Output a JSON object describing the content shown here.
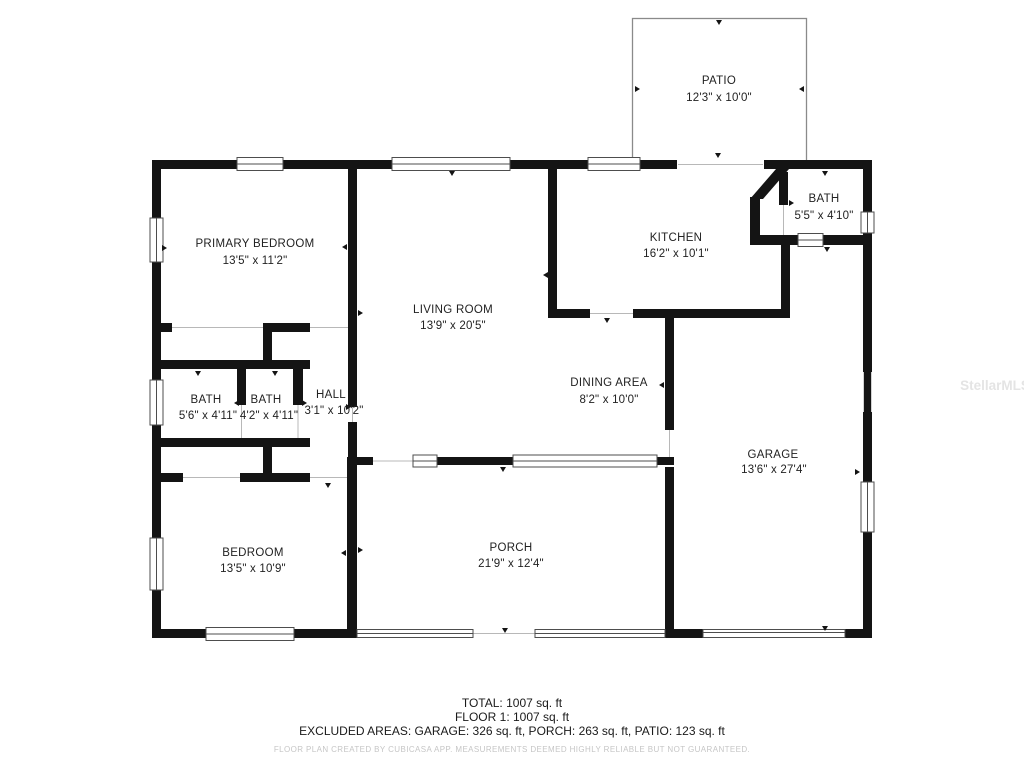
{
  "rooms": [
    {
      "name": "PATIO",
      "dims": "12'3\" x 10'0\""
    },
    {
      "name": "PRIMARY BEDROOM",
      "dims": "13'5\" x 11'2\""
    },
    {
      "name": "KITCHEN",
      "dims": "16'2\" x 10'1\""
    },
    {
      "name": "BATH",
      "dims": "5'5\" x 4'10\""
    },
    {
      "name": "LIVING ROOM",
      "dims": "13'9\" x 20'5\""
    },
    {
      "name": "DINING AREA",
      "dims": "8'2\" x 10'0\""
    },
    {
      "name": "BATH",
      "dims": "5'6\" x 4'11\""
    },
    {
      "name": "BATH",
      "dims": "4'2\" x 4'11\""
    },
    {
      "name": "HALL",
      "dims": "3'1\" x 10'2\""
    },
    {
      "name": "GARAGE",
      "dims": "13'6\" x 27'4\""
    },
    {
      "name": "BEDROOM",
      "dims": "13'5\" x 10'9\""
    },
    {
      "name": "PORCH",
      "dims": "21'9\" x 12'4\""
    }
  ],
  "summary": {
    "total": "TOTAL: 1007 sq. ft",
    "floor1": "FLOOR 1: 1007 sq. ft",
    "excluded": "EXCLUDED AREAS: GARAGE: 326 sq. ft, PORCH: 263 sq. ft, PATIO: 123 sq. ft"
  },
  "footer_disclaimer": "FLOOR PLAN CREATED BY CUBICASA APP. MEASUREMENTS DEEMED HIGHLY RELIABLE BUT NOT GUARANTEED.",
  "watermark": "StellarMLS",
  "colors": {
    "wall": "#141414",
    "window_frame": "#4d4d4d",
    "opening_hairline": "#b8b8b8",
    "patio_outline": "#8a8a8a",
    "label_text": "#222222",
    "disclaimer_text": "#c6c6c6",
    "watermark_text": "#e4e4e4",
    "background": "#ffffff"
  }
}
